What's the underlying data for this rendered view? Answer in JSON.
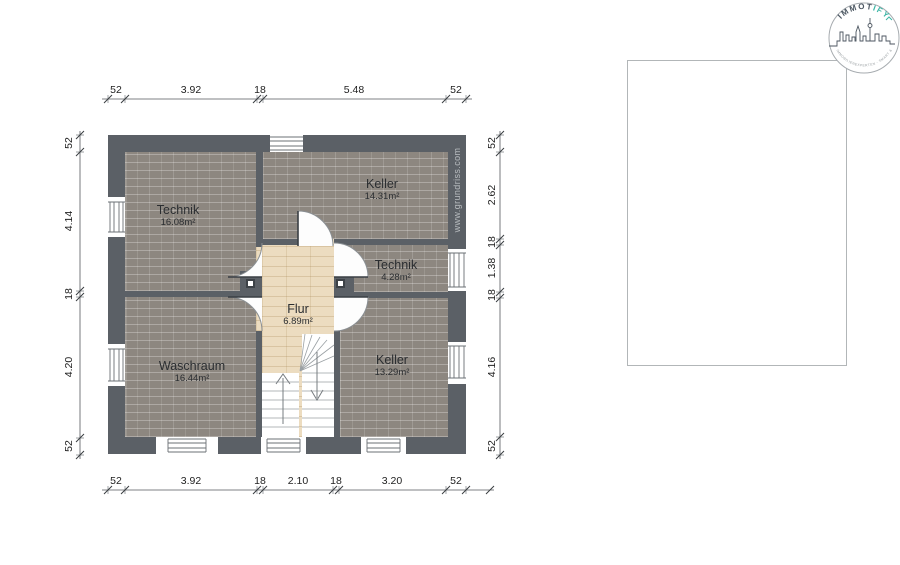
{
  "branding": {
    "logo_primary": "IMMOT",
    "logo_accent": "IFY",
    "tagline": "IHRE IMMOBILIENEXPERTEN - SMART & FAIR",
    "website": "www.grundriss.com"
  },
  "rooms": [
    {
      "name": "Technik",
      "area": "16.08m²"
    },
    {
      "name": "Keller",
      "area": "14.31m²"
    },
    {
      "name": "Technik",
      "area": "4.28m²"
    },
    {
      "name": "Flur",
      "area": "6.89m²"
    },
    {
      "name": "Waschraum",
      "area": "16.44m²"
    },
    {
      "name": "Keller",
      "area": "13.29m²"
    }
  ],
  "dimensions": {
    "top": [
      "52",
      "3.92",
      "18",
      "5.48",
      "52"
    ],
    "bottom": [
      "52",
      "3.92",
      "18",
      "2.10",
      "18",
      "3.20",
      "52"
    ],
    "left": [
      "52",
      "4.14",
      "18",
      "4.20",
      "52"
    ],
    "right": [
      "52",
      "2.62",
      "18",
      "1.38",
      "18",
      "4.16",
      "52"
    ]
  },
  "colors": {
    "wall": "#5b6066",
    "brick_floor": "#8d8780",
    "wood_floor": "#ecdcc0",
    "logo_dark": "#4a5560",
    "logo_teal": "#3ab5a5"
  }
}
